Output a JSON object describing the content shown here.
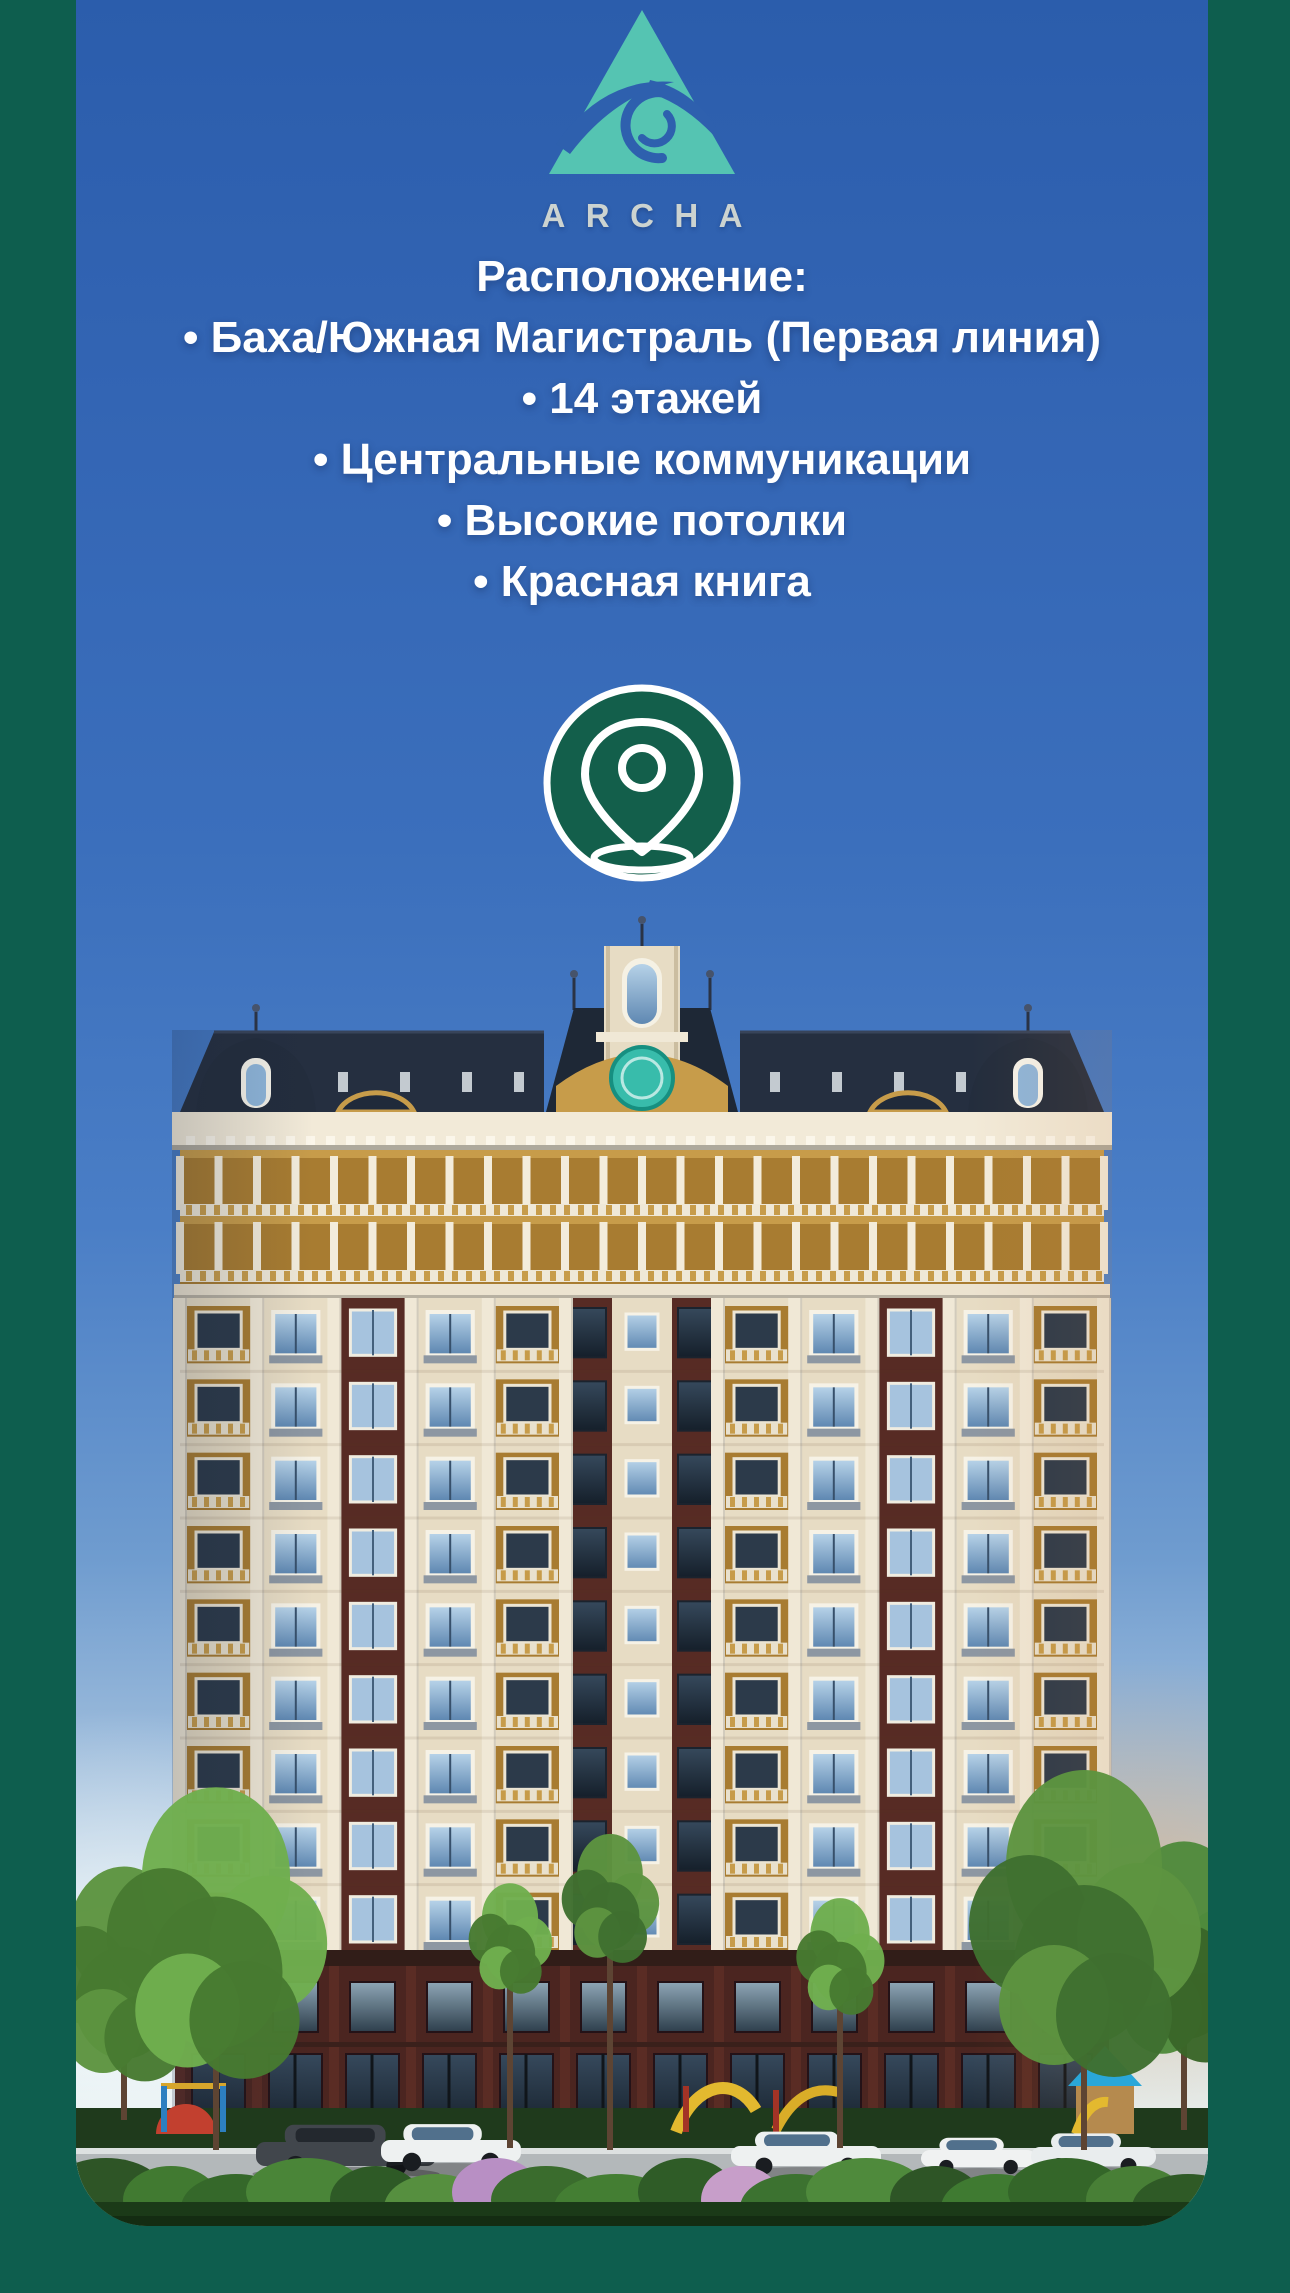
{
  "poster": {
    "brand": {
      "name": "ARCHA"
    },
    "features": {
      "heading": "Расположение:",
      "items": [
        "• Баха/Южная Магистраль (Первая линия)",
        "• 14 этажей",
        "• Центральные коммуникации",
        "• Высокие потолки",
        "• Красная книга"
      ]
    },
    "icons": {
      "logo": "archa-triangle-wave-logo",
      "location": "location-pin-icon"
    },
    "palette": {
      "frame_green": "#0e5e4e",
      "sky_blue": "#3365b4",
      "logo_teal": "#55c4b2",
      "logo_letters": "#ccd3d0",
      "pin_badge_green": "#135f4b",
      "emblem_teal": "#38bcab",
      "facade_cream": "#e7dcc4",
      "facade_gold": "#c79c4a",
      "brick_maroon": "#572b24",
      "roof_slate": "#252f40",
      "text_white": "#ffffff"
    }
  }
}
